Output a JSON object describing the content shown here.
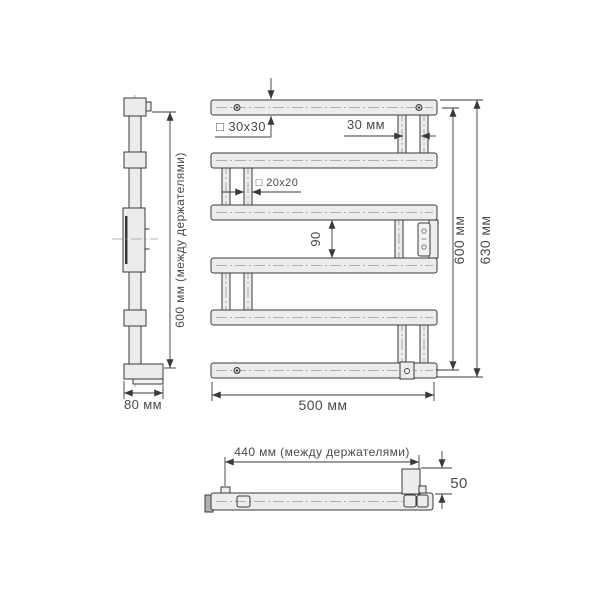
{
  "side_view": {
    "dim_between_holders": "600 мм (между держателями)",
    "dim_depth": "80 мм"
  },
  "front_view": {
    "profile_main": "□ 30x30",
    "dim_tube_spacing": "30 мм",
    "profile_crossbar": "□ 20x20",
    "dim_bar_gap": "90",
    "dim_width": "500 мм",
    "dim_height_between_holders": "600 мм",
    "dim_height_overall": "630 мм"
  },
  "bottom_view": {
    "dim_between_holders": "440 мм (между держателями)",
    "dim_depth": "50"
  },
  "colors": {
    "outline": "#3a3a3a",
    "tube_fill": "#ececec",
    "dim_text": "#4a4a4a",
    "centerline": "#9a9a9a"
  }
}
